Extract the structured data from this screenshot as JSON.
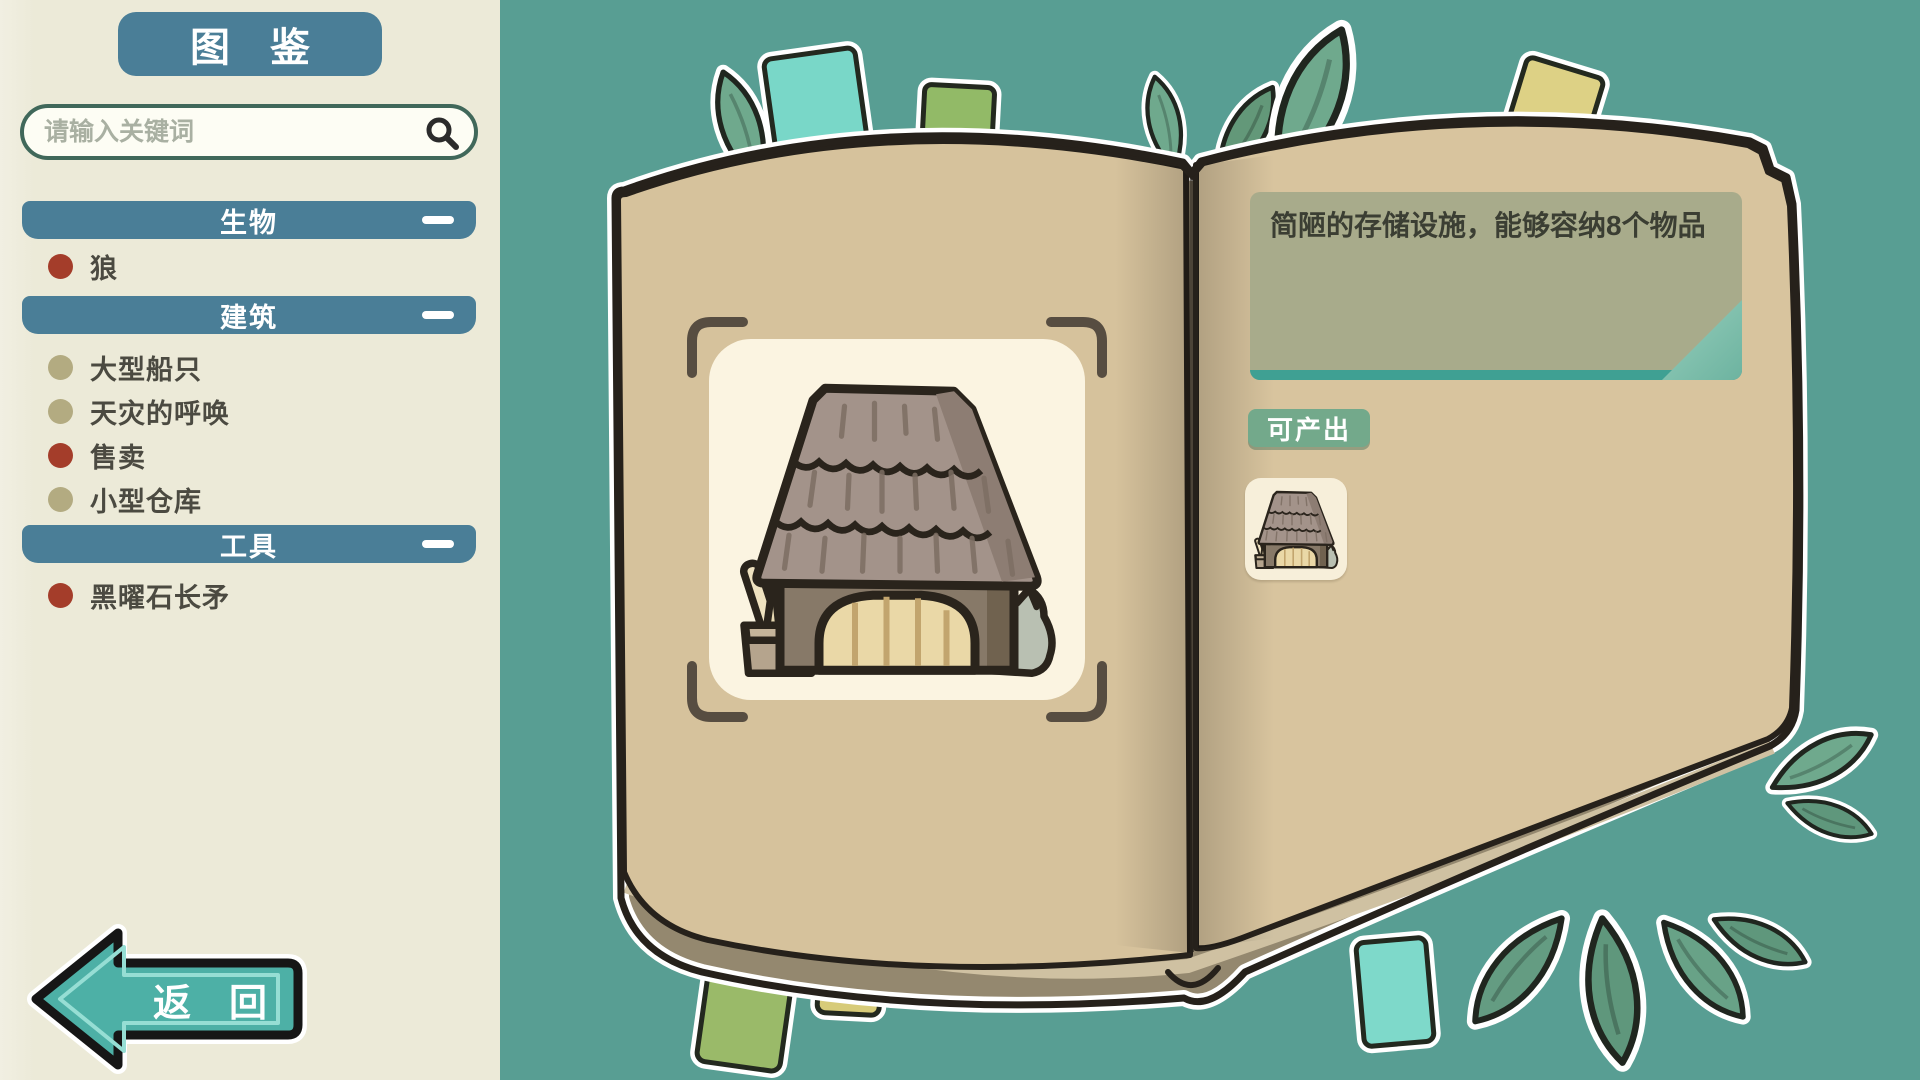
{
  "app": {
    "background_color": "#589e93",
    "accent_blue": "#4a7e97",
    "badge_green": "#73a98b",
    "page_tan": "#d6c29c",
    "back_teal": "#4db0a6"
  },
  "sidebar": {
    "title": "图　鉴",
    "search": {
      "placeholder": "请输入关键词",
      "icon": "search-icon"
    },
    "sections": [
      {
        "label": "生物",
        "collapse_icon": "minus-bar",
        "items": [
          {
            "label": "狼",
            "color": "#a43d2a"
          }
        ]
      },
      {
        "label": "建筑",
        "collapse_icon": "minus-bar",
        "items": [
          {
            "label": "大型船只",
            "color": "#b3ab81"
          },
          {
            "label": "天灾的呼唤",
            "color": "#b3ab81"
          },
          {
            "label": "售卖",
            "color": "#a43d2a"
          },
          {
            "label": "小型仓库",
            "color": "#b3ab81"
          }
        ]
      },
      {
        "label": "工具",
        "collapse_icon": "minus-bar",
        "items": [
          {
            "label": "黑曜石长矛",
            "color": "#a43d2a"
          }
        ]
      }
    ],
    "back_label": "返　回",
    "back_icon": "arrow-left"
  },
  "book": {
    "entry": {
      "description": "简陋的存储设施，能够容纳8个物品",
      "illustration": "small-warehouse"
    },
    "produces": {
      "label": "可产出",
      "items": [
        {
          "icon": "small-warehouse-icon"
        }
      ]
    }
  }
}
